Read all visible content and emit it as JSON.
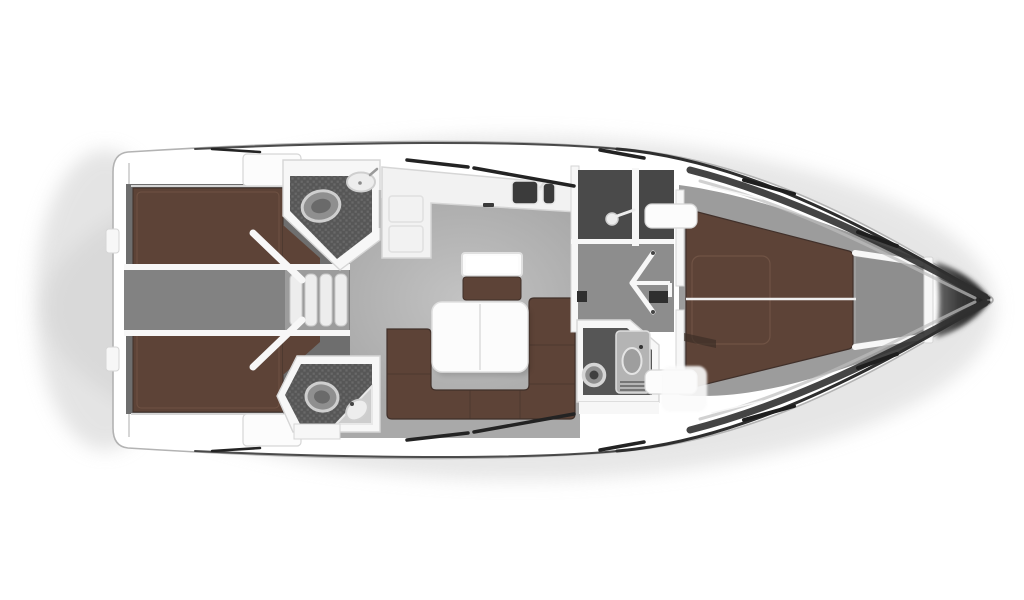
{
  "diagram": {
    "kind": "yacht-interior-floor-plan",
    "view": "top-down",
    "orientation": "bow-right"
  },
  "palette": {
    "pageBg": "#ffffff",
    "hullFill": "#ffffff",
    "hullStroke": "#b3b3b3",
    "deckLine": "#2e2e2e",
    "deckBand": "#303030",
    "deckBandInner": "#bdbdbd",
    "windowSlash": "#232323",
    "shadow": "#cfcfcf",
    "berth": "#5d4337",
    "berthEdge": "#40302a",
    "berthSeam": "#7d5f4e",
    "salonFloor": "#a9a9a9",
    "salonSheen": "#d8d8d8",
    "cabinFloor": "#6e6e6e",
    "engineFloor": "#828282",
    "corridorFloor": "#8d8d8d",
    "stepsBg": "#9c9c9c",
    "stepTread": "#ededed",
    "stepEdge": "#c9c9c9",
    "mosaicBase": "#575757",
    "mosaicTile": "#696969",
    "showerFloor": "#4a4a4a",
    "lockerFloor": "#474747",
    "headFloor": "#565656",
    "fwdFloor": "#9c9c9c",
    "bowLockerFloor": "#8e8e8e",
    "wallWhite": "#f7f7f7",
    "wallEdge": "#d6d6d6",
    "furnitureWhite": "#fcfcfc",
    "furnitureEdge": "#e0e0e0",
    "counterWhite": "#f2f2f2",
    "sinkDark": "#3b3b3b",
    "fixtureGray": "#8f8f8f",
    "fixtureLight": "#ededed",
    "fixtureRing": "#cfcfcf",
    "darkDetail": "#2f2f2f",
    "bowConeLight": "#6a6a6a",
    "bowConeDark": "#1f1f1f"
  },
  "rooms": [
    {
      "id": "aft-cabin-port",
      "features": [
        "double-berth"
      ]
    },
    {
      "id": "aft-cabin-starboard",
      "features": [
        "double-berth"
      ]
    },
    {
      "id": "engine-passage",
      "features": [
        "companionway-steps"
      ]
    },
    {
      "id": "head-port",
      "features": [
        "toilet",
        "sink",
        "mosaic-floor"
      ]
    },
    {
      "id": "head-starboard",
      "features": [
        "toilet",
        "corner-sink",
        "mosaic-floor"
      ]
    },
    {
      "id": "salon",
      "features": [
        "u-sofa",
        "table",
        "nav-seat",
        "nav-table"
      ]
    },
    {
      "id": "galley",
      "features": [
        "l-counter",
        "double-sink",
        "faucet"
      ]
    },
    {
      "id": "shower-room",
      "features": [
        "shower-head"
      ]
    },
    {
      "id": "forward-head",
      "features": [
        "washer-drum",
        "vanity-sink",
        "vent-grille"
      ]
    },
    {
      "id": "forward-cabin",
      "features": [
        "v-berth",
        "bench-port",
        "bench-starboard"
      ]
    },
    {
      "id": "anchor-locker",
      "features": []
    },
    {
      "id": "bow",
      "features": [
        "bow-cone"
      ]
    }
  ],
  "icons": {
    "toilet-icon": "ellipse-with-ring",
    "sink-icon": "oval-basin",
    "faucet-icon": "dot-with-stem",
    "shower-head-icon": "circle-with-wand",
    "washer-icon": "double-ring",
    "steps-icon": "four-treads",
    "door-icon": "angled-white-leaf"
  }
}
